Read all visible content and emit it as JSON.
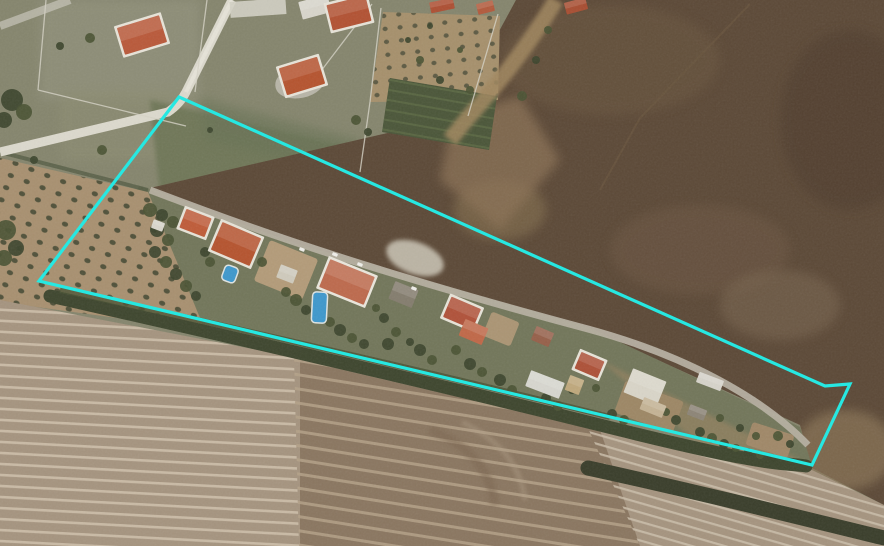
{
  "meta": {
    "view_type": "satellite-aerial-imagery",
    "description": "Aerial view of a rural ribbon of villas along a lane, bounded by a cyan parcel outline, between a dark ploughed field (upper right) and striped furrowed fields (bottom), with small farm parcels and orchards at upper left"
  },
  "colors": {
    "selection_outline": "#26e8e2",
    "scrubland": "#85856d",
    "green_field": "#6f7758",
    "field_dark_brown": "#5c4937",
    "strip_gardens": "#72765a",
    "striped_base": "#a5947f",
    "striped_center": "#87725d",
    "striped_right": "#ab9b88",
    "road_concrete": "#dcd9cd",
    "road_lane": "#b5afa0",
    "dirt_road": "#a1875f",
    "tree_dark": "#3d452e",
    "tree_light": "#4b5434",
    "pool_blue": "#3f98cc",
    "car_white": "#efeee9"
  },
  "overlay": {
    "label": "parcel-selection-outline",
    "points": "179,97 825,386 850,384 812,465 39,281",
    "stroke_width": 3.2
  },
  "scene": {
    "buildings": [
      {
        "x": 120,
        "y": 21,
        "w": 44,
        "h": 28,
        "rot": -17,
        "roof": "#b9593a",
        "wall": "#e7e3d8"
      },
      {
        "x": 300,
        "y": -2,
        "w": 30,
        "h": 18,
        "rot": -15,
        "roof": "#d8d5cb"
      },
      {
        "x": 329,
        "y": 0,
        "w": 40,
        "h": 26,
        "rot": -14,
        "roof": "#b25233",
        "wall": "#e7e3d8"
      },
      {
        "x": 282,
        "y": 62,
        "w": 40,
        "h": 28,
        "rot": -17,
        "roof": "#b5542f",
        "wall": "#e7e3d8"
      },
      {
        "x": 430,
        "y": 0,
        "w": 24,
        "h": 11,
        "rot": -12,
        "roof": "#ad4f33"
      },
      {
        "x": 477,
        "y": 2,
        "w": 17,
        "h": 11,
        "rot": -14,
        "roof": "#b25a3c"
      },
      {
        "x": 565,
        "y": 0,
        "w": 22,
        "h": 12,
        "rot": -15,
        "roof": "#a84e32"
      },
      {
        "x": 152,
        "y": 221,
        "w": 12,
        "h": 9,
        "rot": 20,
        "roof": "#d9d6cc"
      },
      {
        "x": 182,
        "y": 213,
        "w": 27,
        "h": 20,
        "rot": 21,
        "roof": "#bf5c39",
        "wall": "#e7e3d8"
      },
      {
        "x": 215,
        "y": 229,
        "w": 42,
        "h": 30,
        "rot": 23,
        "roof": "#b5542f",
        "wall": "#e7e3d8"
      },
      {
        "x": 278,
        "y": 267,
        "w": 18,
        "h": 14,
        "rot": 21,
        "roof": "#cfcabc"
      },
      {
        "x": 323,
        "y": 267,
        "w": 48,
        "h": 30,
        "rot": 22,
        "roof": "#bd6a4d",
        "wall": "#eae6dc"
      },
      {
        "x": 391,
        "y": 285,
        "w": 25,
        "h": 19,
        "rot": 22,
        "roof": "#847d6e"
      },
      {
        "x": 446,
        "y": 302,
        "w": 32,
        "h": 22,
        "rot": 23,
        "roof": "#b0523a",
        "wall": "#e7e3d8"
      },
      {
        "x": 461,
        "y": 323,
        "w": 25,
        "h": 18,
        "rot": 23,
        "roof": "#c06848"
      },
      {
        "x": 533,
        "y": 329,
        "w": 19,
        "h": 15,
        "rot": 23,
        "roof": "#96604a"
      },
      {
        "x": 577,
        "y": 356,
        "w": 25,
        "h": 18,
        "rot": 23,
        "roof": "#ad5138",
        "wall": "#e7e3d8"
      },
      {
        "x": 527,
        "y": 376,
        "w": 36,
        "h": 17,
        "rot": 21,
        "roof": "#d7d6cf"
      },
      {
        "x": 567,
        "y": 377,
        "w": 15,
        "h": 16,
        "rot": 21,
        "roof": "#bfa87c"
      },
      {
        "x": 627,
        "y": 374,
        "w": 36,
        "h": 26,
        "rot": 22,
        "roof": "#d9d5c8"
      },
      {
        "x": 641,
        "y": 401,
        "w": 24,
        "h": 13,
        "rot": 22,
        "roof": "#c4b395"
      },
      {
        "x": 697,
        "y": 376,
        "w": 26,
        "h": 11,
        "rot": 21,
        "roof": "#d6d3ca"
      },
      {
        "x": 688,
        "y": 407,
        "w": 18,
        "h": 11,
        "rot": 21,
        "roof": "#8d8577"
      }
    ],
    "pools": [
      {
        "x": 312,
        "y": 292,
        "w": 15,
        "h": 31,
        "rot": 3
      },
      {
        "x": 223,
        "y": 266,
        "w": 14,
        "h": 16,
        "rot": 20
      }
    ],
    "cars": [
      [
        358,
        262
      ],
      [
        412,
        286
      ],
      [
        333,
        252
      ],
      [
        300,
        247
      ]
    ],
    "dirt_patches": [
      {
        "x": 260,
        "y": 248,
        "w": 52,
        "h": 44,
        "rot": 22,
        "fill": "#b39b79"
      },
      {
        "x": 618,
        "y": 390,
        "w": 62,
        "h": 34,
        "rot": 20,
        "fill": "#9d8765"
      },
      {
        "x": 748,
        "y": 428,
        "w": 44,
        "h": 24,
        "rot": 18,
        "fill": "#a08868"
      },
      {
        "x": 486,
        "y": 316,
        "w": 30,
        "h": 26,
        "rot": 22,
        "fill": "#ab9574"
      }
    ],
    "trees": [
      [
        150,
        210,
        7
      ],
      [
        162,
        215,
        6
      ],
      [
        173,
        222,
        6
      ],
      [
        157,
        230,
        7
      ],
      [
        168,
        240,
        6
      ],
      [
        155,
        252,
        6
      ],
      [
        166,
        262,
        6
      ],
      [
        176,
        274,
        6
      ],
      [
        186,
        286,
        6
      ],
      [
        196,
        296,
        5
      ],
      [
        210,
        262,
        5
      ],
      [
        205,
        252,
        5
      ],
      [
        262,
        262,
        5
      ],
      [
        250,
        256,
        4
      ],
      [
        296,
        300,
        6
      ],
      [
        306,
        310,
        5
      ],
      [
        286,
        292,
        5
      ],
      [
        340,
        330,
        6
      ],
      [
        352,
        338,
        5
      ],
      [
        364,
        344,
        5
      ],
      [
        330,
        322,
        5
      ],
      [
        384,
        318,
        5
      ],
      [
        396,
        332,
        5
      ],
      [
        388,
        344,
        6
      ],
      [
        376,
        308,
        4
      ],
      [
        420,
        350,
        6
      ],
      [
        432,
        360,
        5
      ],
      [
        410,
        342,
        4
      ],
      [
        456,
        350,
        5
      ],
      [
        470,
        364,
        6
      ],
      [
        482,
        372,
        5
      ],
      [
        500,
        380,
        6
      ],
      [
        512,
        390,
        5
      ],
      [
        546,
        398,
        5
      ],
      [
        558,
        406,
        5
      ],
      [
        572,
        390,
        4
      ],
      [
        596,
        388,
        4
      ],
      [
        612,
        414,
        5
      ],
      [
        624,
        420,
        5
      ],
      [
        676,
        420,
        5
      ],
      [
        666,
        412,
        4
      ],
      [
        700,
        432,
        5
      ],
      [
        712,
        438,
        5
      ],
      [
        724,
        444,
        5
      ],
      [
        736,
        448,
        4
      ],
      [
        748,
        452,
        4
      ],
      [
        760,
        455,
        4
      ],
      [
        772,
        458,
        4
      ],
      [
        778,
        436,
        5
      ],
      [
        790,
        444,
        4
      ],
      [
        720,
        418,
        4
      ],
      [
        740,
        428,
        4
      ],
      [
        756,
        436,
        4
      ],
      [
        12,
        100,
        11
      ],
      [
        24,
        112,
        8
      ],
      [
        4,
        120,
        8
      ],
      [
        90,
        38,
        5
      ],
      [
        60,
        46,
        4
      ],
      [
        102,
        150,
        5
      ],
      [
        34,
        160,
        4
      ],
      [
        6,
        230,
        10
      ],
      [
        16,
        248,
        8
      ],
      [
        4,
        258,
        8
      ],
      [
        210,
        130,
        3
      ],
      [
        356,
        120,
        5
      ],
      [
        368,
        132,
        4
      ],
      [
        420,
        60,
        4
      ],
      [
        440,
        80,
        4
      ],
      [
        460,
        50,
        3
      ],
      [
        408,
        40,
        3
      ],
      [
        470,
        90,
        4
      ],
      [
        430,
        26,
        3
      ],
      [
        522,
        96,
        5
      ],
      [
        536,
        60,
        4
      ],
      [
        548,
        30,
        4
      ]
    ]
  }
}
